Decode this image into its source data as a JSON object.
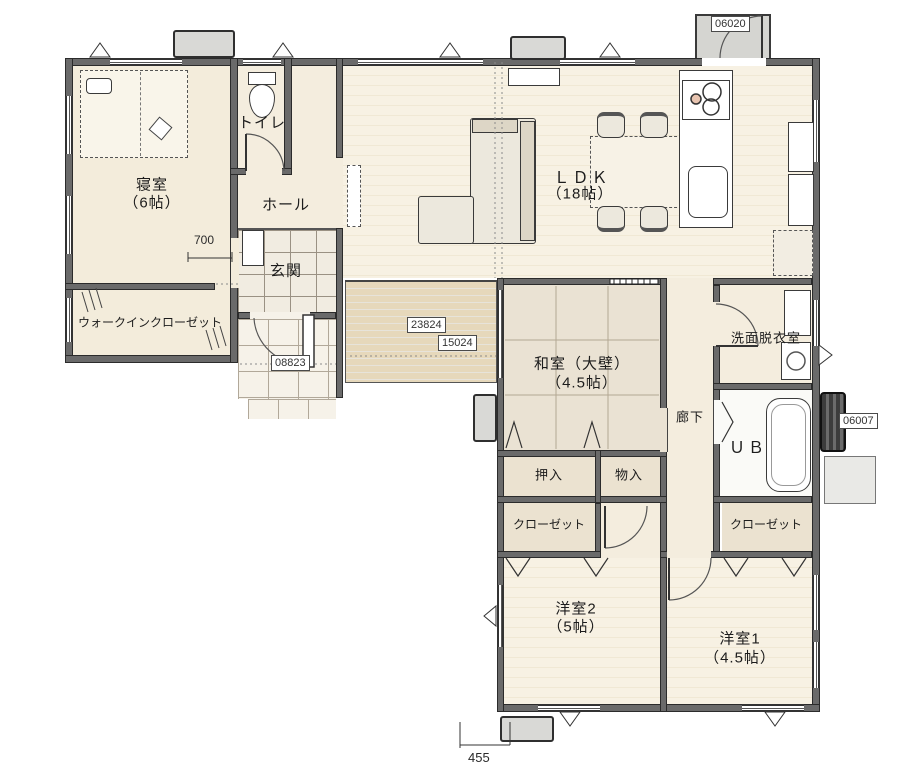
{
  "plan": {
    "title": "1F floor plan",
    "rooms": {
      "bedroom": {
        "name": "寝室",
        "size": "（6帖）"
      },
      "toilet": {
        "name": "トイレ"
      },
      "hall": {
        "name": "ホール"
      },
      "genkan": {
        "name": "玄関"
      },
      "wic": {
        "name": "ウォークインクローゼット"
      },
      "ldk": {
        "name": "ＬＤＫ",
        "size": "（18帖）"
      },
      "washitsu": {
        "name": "和室（大壁）",
        "size": "（4.5帖）"
      },
      "senmen": {
        "name": "洗面脱衣室"
      },
      "rouka": {
        "name": "廊下"
      },
      "ub": {
        "name": "ＵＢ"
      },
      "oshiire": {
        "name": "押入"
      },
      "monoire": {
        "name": "物入"
      },
      "closet_y2": {
        "name": "クローゼット"
      },
      "closet_y1": {
        "name": "クローゼット"
      },
      "youshitsu2": {
        "name": "洋室2",
        "size": "（5帖）"
      },
      "youshitsu1": {
        "name": "洋室1",
        "size": "（4.5帖）"
      }
    },
    "dimensions": {
      "hall_width": "700",
      "deck_a": "23824",
      "deck_b": "15024",
      "entrance": "08823",
      "back_door": "06020",
      "bath_side": "06007",
      "south": "455"
    },
    "colors": {
      "wall": "#6a6a6a",
      "floor": "#f7f1e3",
      "tatami": "#eae2d3",
      "deck": "#e6d8bb",
      "tile": "#f1ece1",
      "outside": "#ffffff",
      "line": "#2b2b2b"
    }
  }
}
